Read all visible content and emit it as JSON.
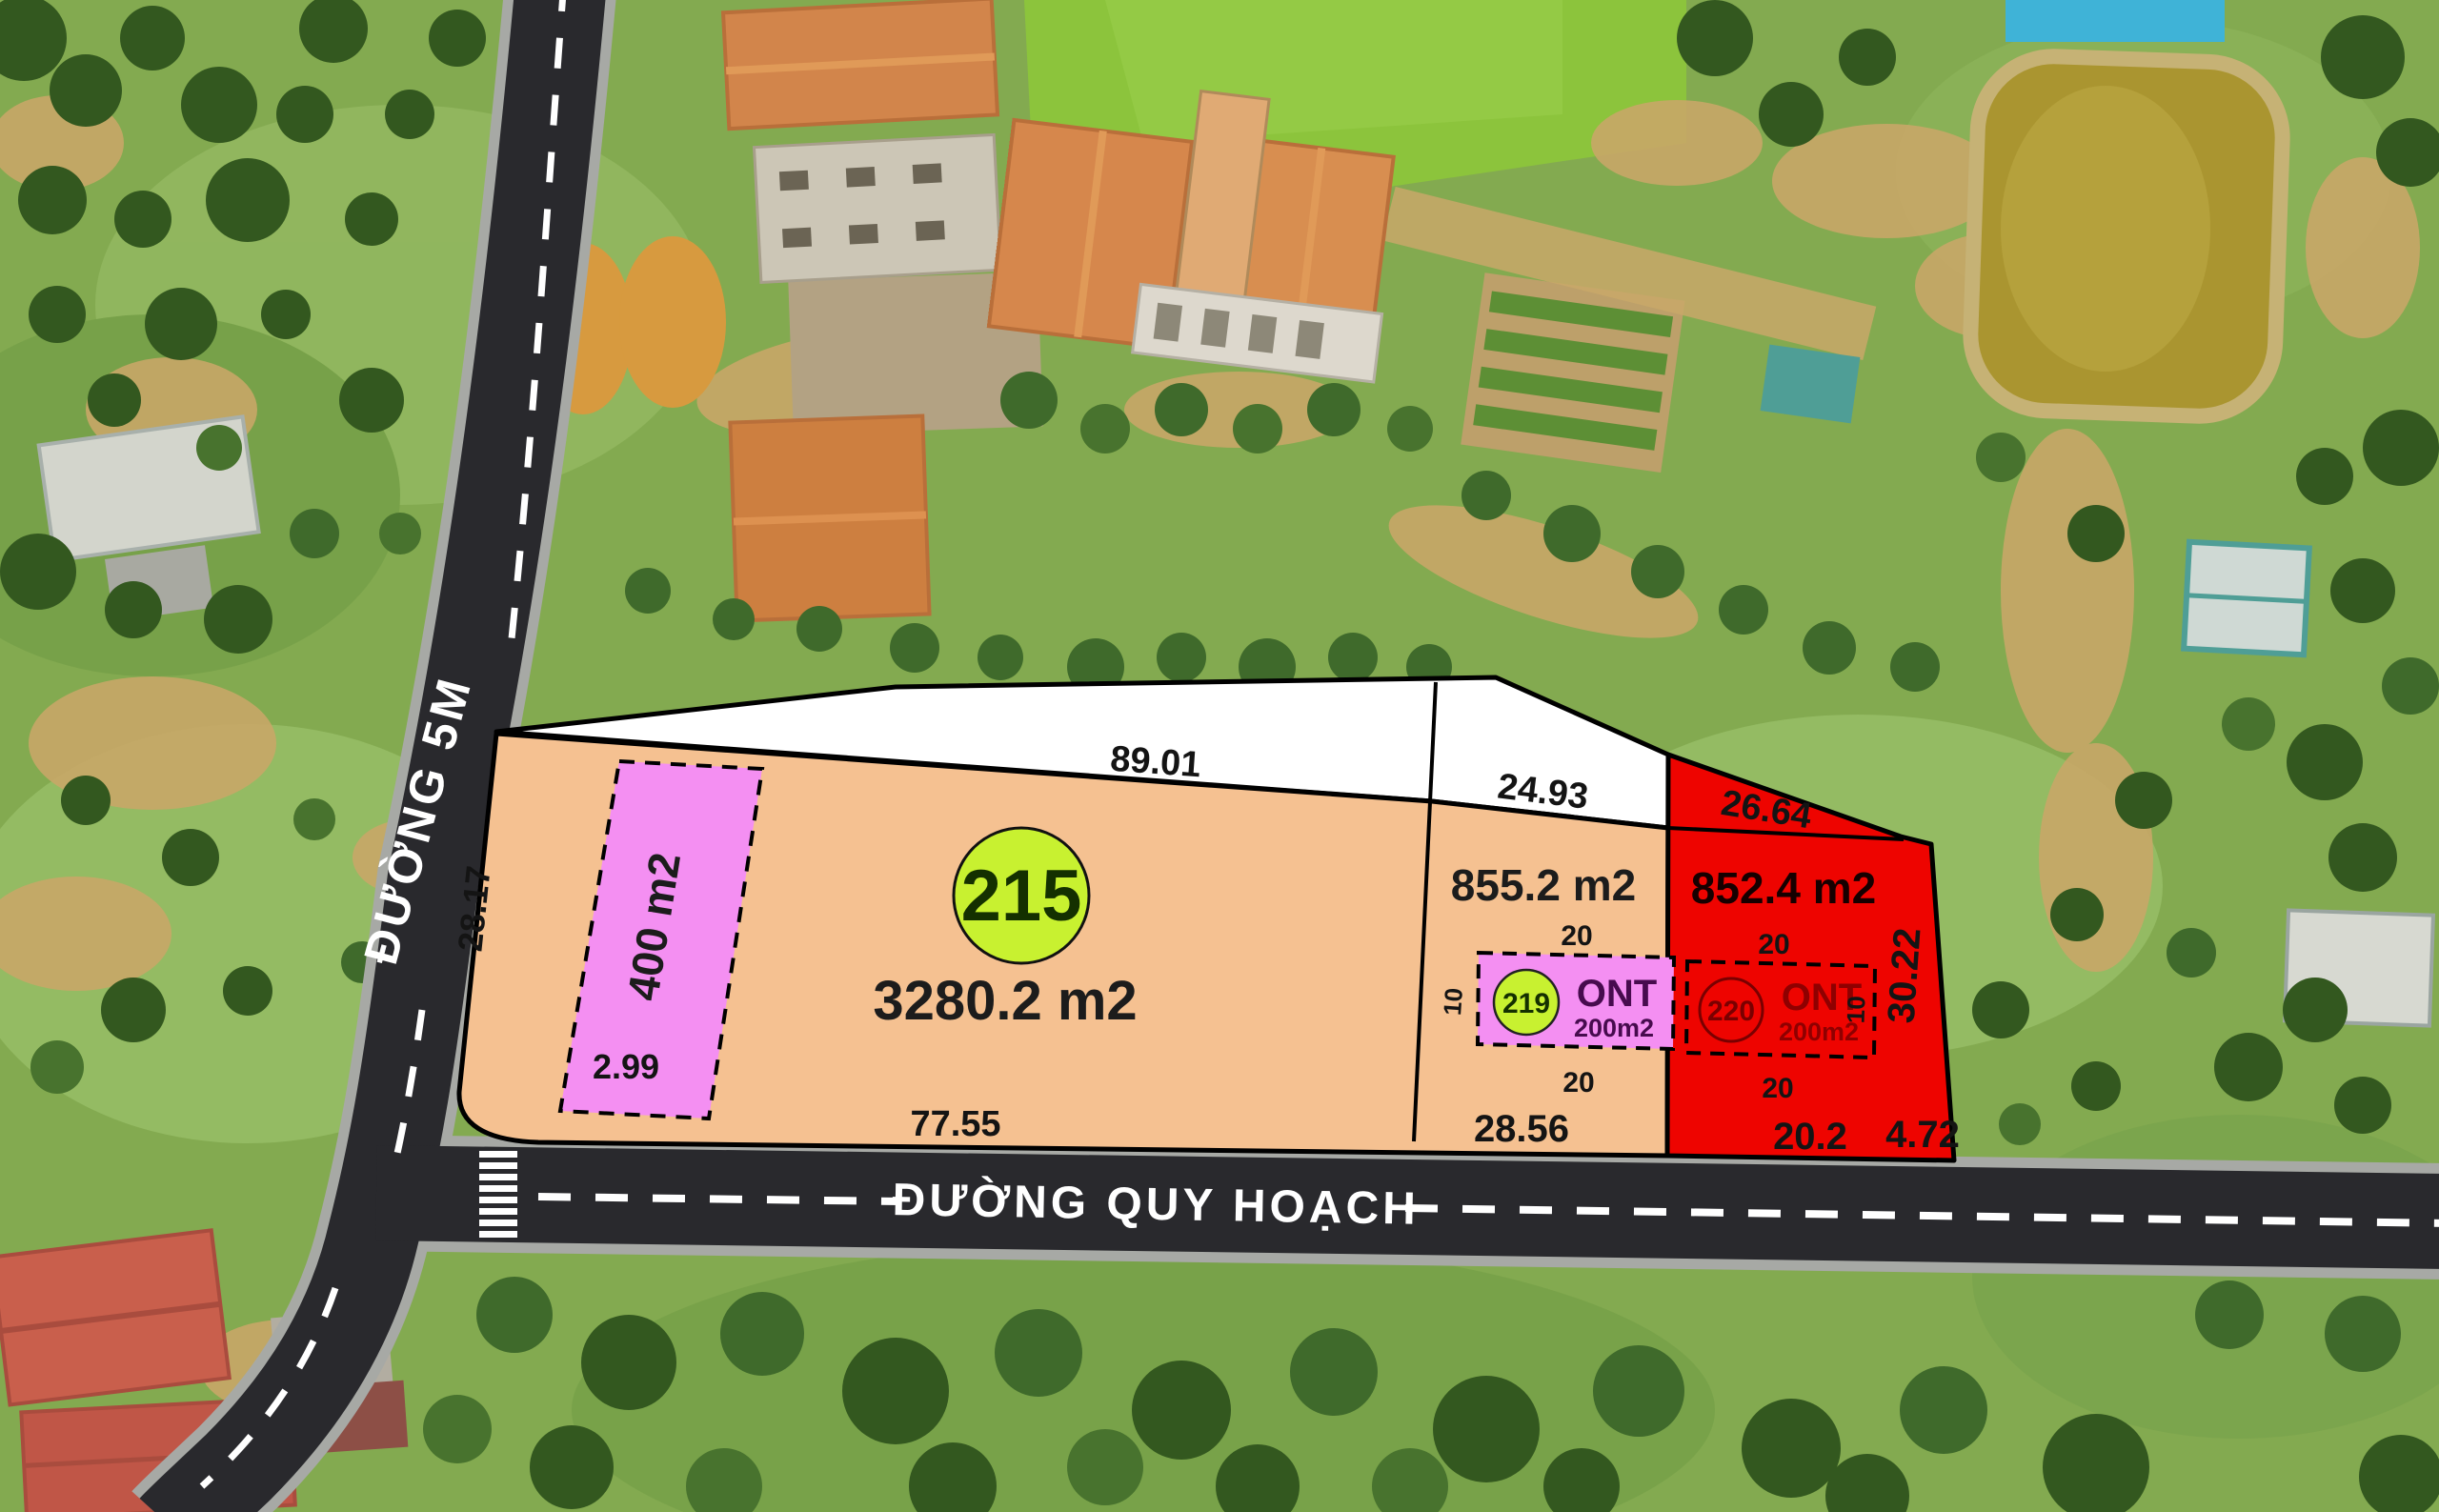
{
  "roads": {
    "vertical": {
      "label": "ĐƯỜNG 5M"
    },
    "planned": {
      "label": "ĐƯỜNG QUY HOẠCH"
    }
  },
  "plots": {
    "plot215": {
      "number": "215",
      "area": "3280.2 m2",
      "edge_top": "89.01",
      "edge_left": "28.17",
      "edge_bottom": "77.55"
    },
    "plot400": {
      "area": "400 m2",
      "edge_bottom": "2.99"
    },
    "plot855": {
      "area": "855.2 m2",
      "edge_top": "24.93",
      "edge_bottom": "28.56"
    },
    "plot852": {
      "area": "852.4 m2",
      "edge_top": "26.64",
      "edge_bottom_left": "20.2",
      "edge_bottom_right": "4.72",
      "edge_right": "30.22"
    },
    "ont219": {
      "number": "219",
      "type_label": "ONT",
      "area": "200m2",
      "edge_top": "20",
      "edge_bottom": "20",
      "edge_left": "10"
    },
    "ont220": {
      "number": "220",
      "type_label": "ONT",
      "area": "200m2",
      "edge_top": "20",
      "edge_bottom": "20",
      "edge_right": "10"
    }
  },
  "colors": {
    "plot_tan": "#f5c191",
    "plot_pink": "#f48ff2",
    "plot_red": "#ee0400",
    "plot_white": "#ffffff",
    "marker_green": "#c8f130",
    "road_asphalt": "#29292d",
    "road_curb": "#a7a9a5",
    "lane_white": "#ffffff",
    "pond_water": "#aa9530"
  }
}
